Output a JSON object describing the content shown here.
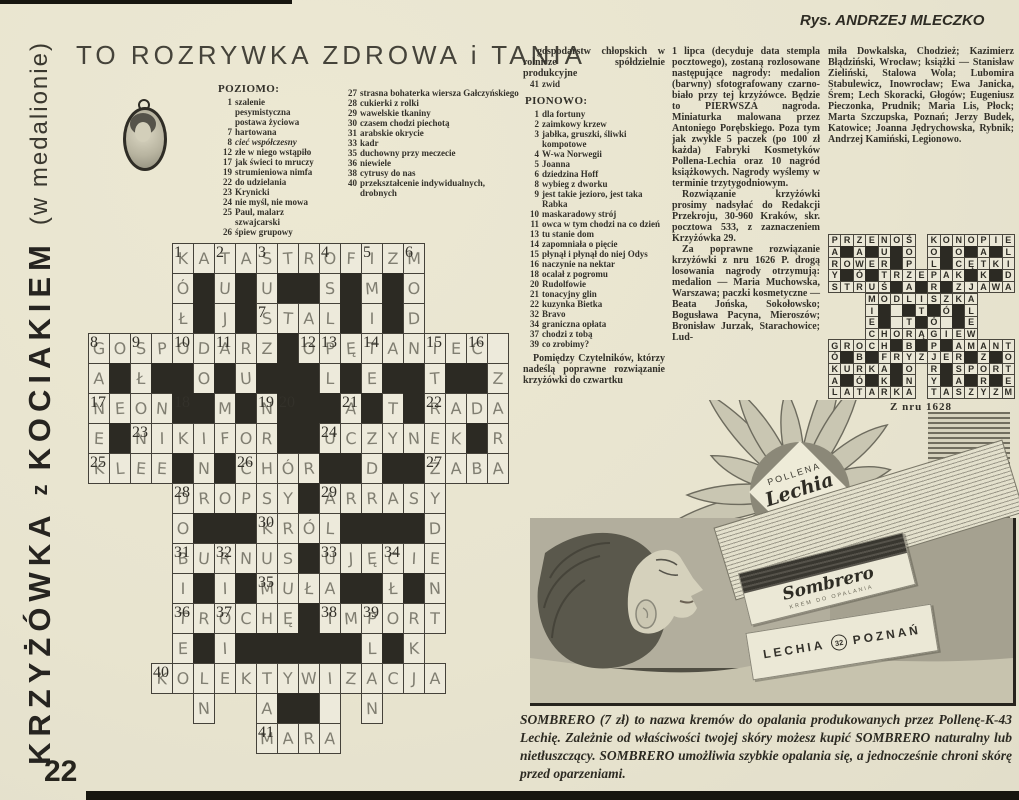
{
  "page": {
    "title": "TO ROZRYWKA ZDROWA i TANIA",
    "credit": "Rys. ANDRZEJ MLECZKO",
    "vertical_title_1": "KRZYŻÓWKA",
    "vertical_title_z": "z",
    "vertical_title_2": "KOCIAKIEM",
    "vertical_subtitle": "(w medalionie)",
    "page_number": "22"
  },
  "clues": {
    "across_header": "POZIOMO:",
    "down_header": "PIONOWO:",
    "across": [
      {
        "n": "1",
        "text": "szalenie pesymistyczna postawa życiowa"
      },
      {
        "n": "7",
        "text": "hartowana"
      },
      {
        "n": "8",
        "text": "cieć współczesny",
        "italic": true
      },
      {
        "n": "12",
        "text": "złe w niego wstąpiło"
      },
      {
        "n": "17",
        "text": "jak świeci to mruczy"
      },
      {
        "n": "19",
        "text": "strumieniowa nimfa"
      },
      {
        "n": "22",
        "text": "do udzielania"
      },
      {
        "n": "23",
        "text": "Krynicki"
      },
      {
        "n": "24",
        "text": "nie myśl, nie mowa"
      },
      {
        "n": "25",
        "text": "Paul, malarz szwajcarski"
      },
      {
        "n": "26",
        "text": "śpiew grupowy"
      }
    ],
    "across2": [
      {
        "n": "27",
        "text": "strasna bohaterka wiersza Gałczyńskiego"
      },
      {
        "n": "28",
        "text": "cukierki z rolki"
      },
      {
        "n": "29",
        "text": "wawelskie tkaniny"
      },
      {
        "n": "30",
        "text": "czasem chodzi piechotą"
      },
      {
        "n": "31",
        "text": "arabskie okrycie"
      },
      {
        "n": "33",
        "text": "kadr"
      },
      {
        "n": "35",
        "text": "duchowny przy meczecie"
      },
      {
        "n": "36",
        "text": "niewiele"
      },
      {
        "n": "38",
        "text": "cytrusy do nas"
      },
      {
        "n": "40",
        "text": "przekształcenie indywidualnych, drobnych"
      }
    ],
    "across_cont": "gospodarstw chłopskich w rolnicze spółdzielnie produkcyjne",
    "across_last": {
      "n": "41",
      "text": "zwid"
    },
    "down": [
      {
        "n": "1",
        "text": "dla fortuny"
      },
      {
        "n": "2",
        "text": "zaimkowy krzew"
      },
      {
        "n": "3",
        "text": "jabłka, gruszki, śliwki kompotowe"
      },
      {
        "n": "4",
        "text": "W-wa Norwegii"
      },
      {
        "n": "5",
        "text": "Joanna"
      },
      {
        "n": "6",
        "text": "dziedzina Hoff"
      },
      {
        "n": "8",
        "text": "wybieg z dworku"
      },
      {
        "n": "9",
        "text": "jest takie jezioro, jest taka Rabka"
      },
      {
        "n": "10",
        "text": "maskaradowy strój"
      },
      {
        "n": "11",
        "text": "owca w tym chodzi na co dzień"
      },
      {
        "n": "13",
        "text": "tu stanie dom"
      },
      {
        "n": "14",
        "text": "zapomniała o pięcie"
      },
      {
        "n": "15",
        "text": "płynął i płynął do niej Odys"
      },
      {
        "n": "16",
        "text": "naczynie na nektar"
      },
      {
        "n": "18",
        "text": "ocalał z pogromu"
      },
      {
        "n": "20",
        "text": "Rudolfowie"
      },
      {
        "n": "21",
        "text": "tonacyjny glin"
      },
      {
        "n": "22",
        "text": "kuzynka Bietka"
      },
      {
        "n": "32",
        "text": "Bravo"
      },
      {
        "n": "34",
        "text": "graniczna opłata"
      },
      {
        "n": "37",
        "text": "chodzi z tobą"
      },
      {
        "n": "39",
        "text": "co zrobimy?"
      }
    ]
  },
  "articles": {
    "intro": "Pomiędzy Czytelników, którzy nadeślą poprawne rozwiązanie krzyżówki do czwartku",
    "col2": [
      "1 lipca (decyduje data stempla pocztowego), zostaną rozlosowane następujące nagrody: medalion (barwny) sfotografowany czarno-biało przy tej krzyżówce. Będzie to PIERWSZA nagroda. Miniaturka malowana przez Antoniego Porębskiego. Poza tym jak zwykle 5 paczek (po 100 zł każda) Fabryki Kosmetyków Pollena-Lechia oraz 10 nagród książkowych. Nagrody wyślemy w terminie trzytygodniowym.",
      "Rozwiązanie krzyżówki prosimy nadsyłać do Redakcji Przekroju, 30-960 Kraków, skr. pocztowa 533, z zaznaczeniem Krzyżówka 29.",
      "Za poprawne rozwiązanie krzyżówki z nru 1626 P. drogą losowania nagrody otrzymują: medalion — Maria Muchowska, Warszawa; paczki kosmetyczne — Beata Jońska, Sokołowsko; Bogusława Pacyna, Mieroszów; Bronisław Jurzak, Starachowice; Lud-"
    ],
    "col3": [
      "miła Dowkalska, Chodzież; Kazimierz Błądziński, Wrocław; książki — Stanisław Zieliński, Stalowa Wola; Lubomira Stabulewicz, Inowrocław; Ewa Janicka, Śrem; Lech Skoracki, Głogów; Eugeniusz Pieczonka, Prudnik; Maria Lis, Płock; Marta Szczupska, Poznań; Jerzy Budek, Katowice; Joanna Jędrychowska, Rybnik; Andrzej Kamiński, Legionowo."
    ]
  },
  "crossword": {
    "rows": [
      "    KATASTROFIZM    ",
      "    Ó#U#U##S#M#O    ",
      "    Ł#J#STAL#I#D    ",
      "GOSPODARZ#OPĘTANIEC.",
      "A#Ł##O#U###L#E##T##Z",
      "NEON##M#N###A#T#RADA",
      "E#NIKIFOR##UCZYNEK#R",
      "KLEE#N#CHÓR##D##ŻABA",
      "    DROPSY#ARRASY   ",
      "    O###KRÓL####D   ",
      "    BURNUS#UJĘCIE   ",
      "    I#I#MUŁA##Ł#N   ",
      "    TROCHĘ#IMPORT   ",
      "    E#I######L#K    ",
      "   KOLEKTYWIZACJA   ",
      "     N  A##. N      ",
      "        MARA        "
    ],
    "numbers": [
      [
        1,
        5,
        "1"
      ],
      [
        1,
        7,
        "2"
      ],
      [
        1,
        9,
        "3"
      ],
      [
        1,
        12,
        "4"
      ],
      [
        1,
        14,
        "5"
      ],
      [
        1,
        16,
        "6"
      ],
      [
        3,
        9,
        "7"
      ],
      [
        4,
        1,
        "8"
      ],
      [
        4,
        3,
        "9"
      ],
      [
        4,
        5,
        "10"
      ],
      [
        4,
        7,
        "11"
      ],
      [
        4,
        11,
        "12"
      ],
      [
        4,
        12,
        "13"
      ],
      [
        4,
        14,
        "14"
      ],
      [
        4,
        17,
        "15"
      ],
      [
        4,
        19,
        "16"
      ],
      [
        6,
        1,
        "17"
      ],
      [
        6,
        5,
        "18"
      ],
      [
        6,
        9,
        "19"
      ],
      [
        6,
        10,
        "20"
      ],
      [
        6,
        13,
        "21"
      ],
      [
        6,
        17,
        "22"
      ],
      [
        7,
        3,
        "23"
      ],
      [
        7,
        12,
        "24"
      ],
      [
        8,
        1,
        "25"
      ],
      [
        8,
        8,
        "26"
      ],
      [
        8,
        17,
        "27"
      ],
      [
        9,
        5,
        "28"
      ],
      [
        9,
        12,
        "29"
      ],
      [
        10,
        9,
        "30"
      ],
      [
        11,
        5,
        "31"
      ],
      [
        11,
        7,
        "32"
      ],
      [
        11,
        12,
        "33"
      ],
      [
        11,
        15,
        "34"
      ],
      [
        12,
        9,
        "35"
      ],
      [
        13,
        5,
        "36"
      ],
      [
        13,
        7,
        "37"
      ],
      [
        13,
        12,
        "38"
      ],
      [
        13,
        14,
        "39"
      ],
      [
        15,
        4,
        "40"
      ],
      [
        17,
        9,
        "41"
      ]
    ]
  },
  "solution": {
    "caption": "Z nru 1628",
    "rows": [
      "PRZENOŚ KONOPIE",
      "A#A#U#O O#O#A#L",
      "ROWER#P L#CĘTKI",
      "Y#Ó#TRZEPAK#K#D",
      "STRUŚ#A#R#ZJAWA",
      "   MODLISZKA   ",
      "   I#.#T#Ó#L   ",
      "   E#.T#Ó.#E   ",
      "   CHORĄGIEW   ",
      "GROCH#B#P#AMANT",
      "Ó#B#FRYZJER#Z#O",
      "KURKA#O R#SPORT",
      "A#Ó#K#N Y#A#R#E",
      "LATARKA TASZYZM"
    ]
  },
  "ad": {
    "brand_top": "POLLENA",
    "brand_script": "Lechia",
    "brand_city": "POZNAŃ",
    "product_script": "Sombrero",
    "product_tiny": "KREM DO OPALANIA",
    "box_brand": "LECHIA",
    "box_num": "32",
    "box_city": "POZNAŃ",
    "caption": "SOMBRERO (7 zł) to nazwa kremów do opalania produkowanych przez Pollenę-Lechię. Zależnie od właściwości twojej skóry możesz kupić SOMBRERO naturalny lub nietłuszczący. SOMBRERO umożliwia szybkie opalania się, a jednocześnie chroni skórę przed oparzeniami.",
    "code": "K-43"
  }
}
